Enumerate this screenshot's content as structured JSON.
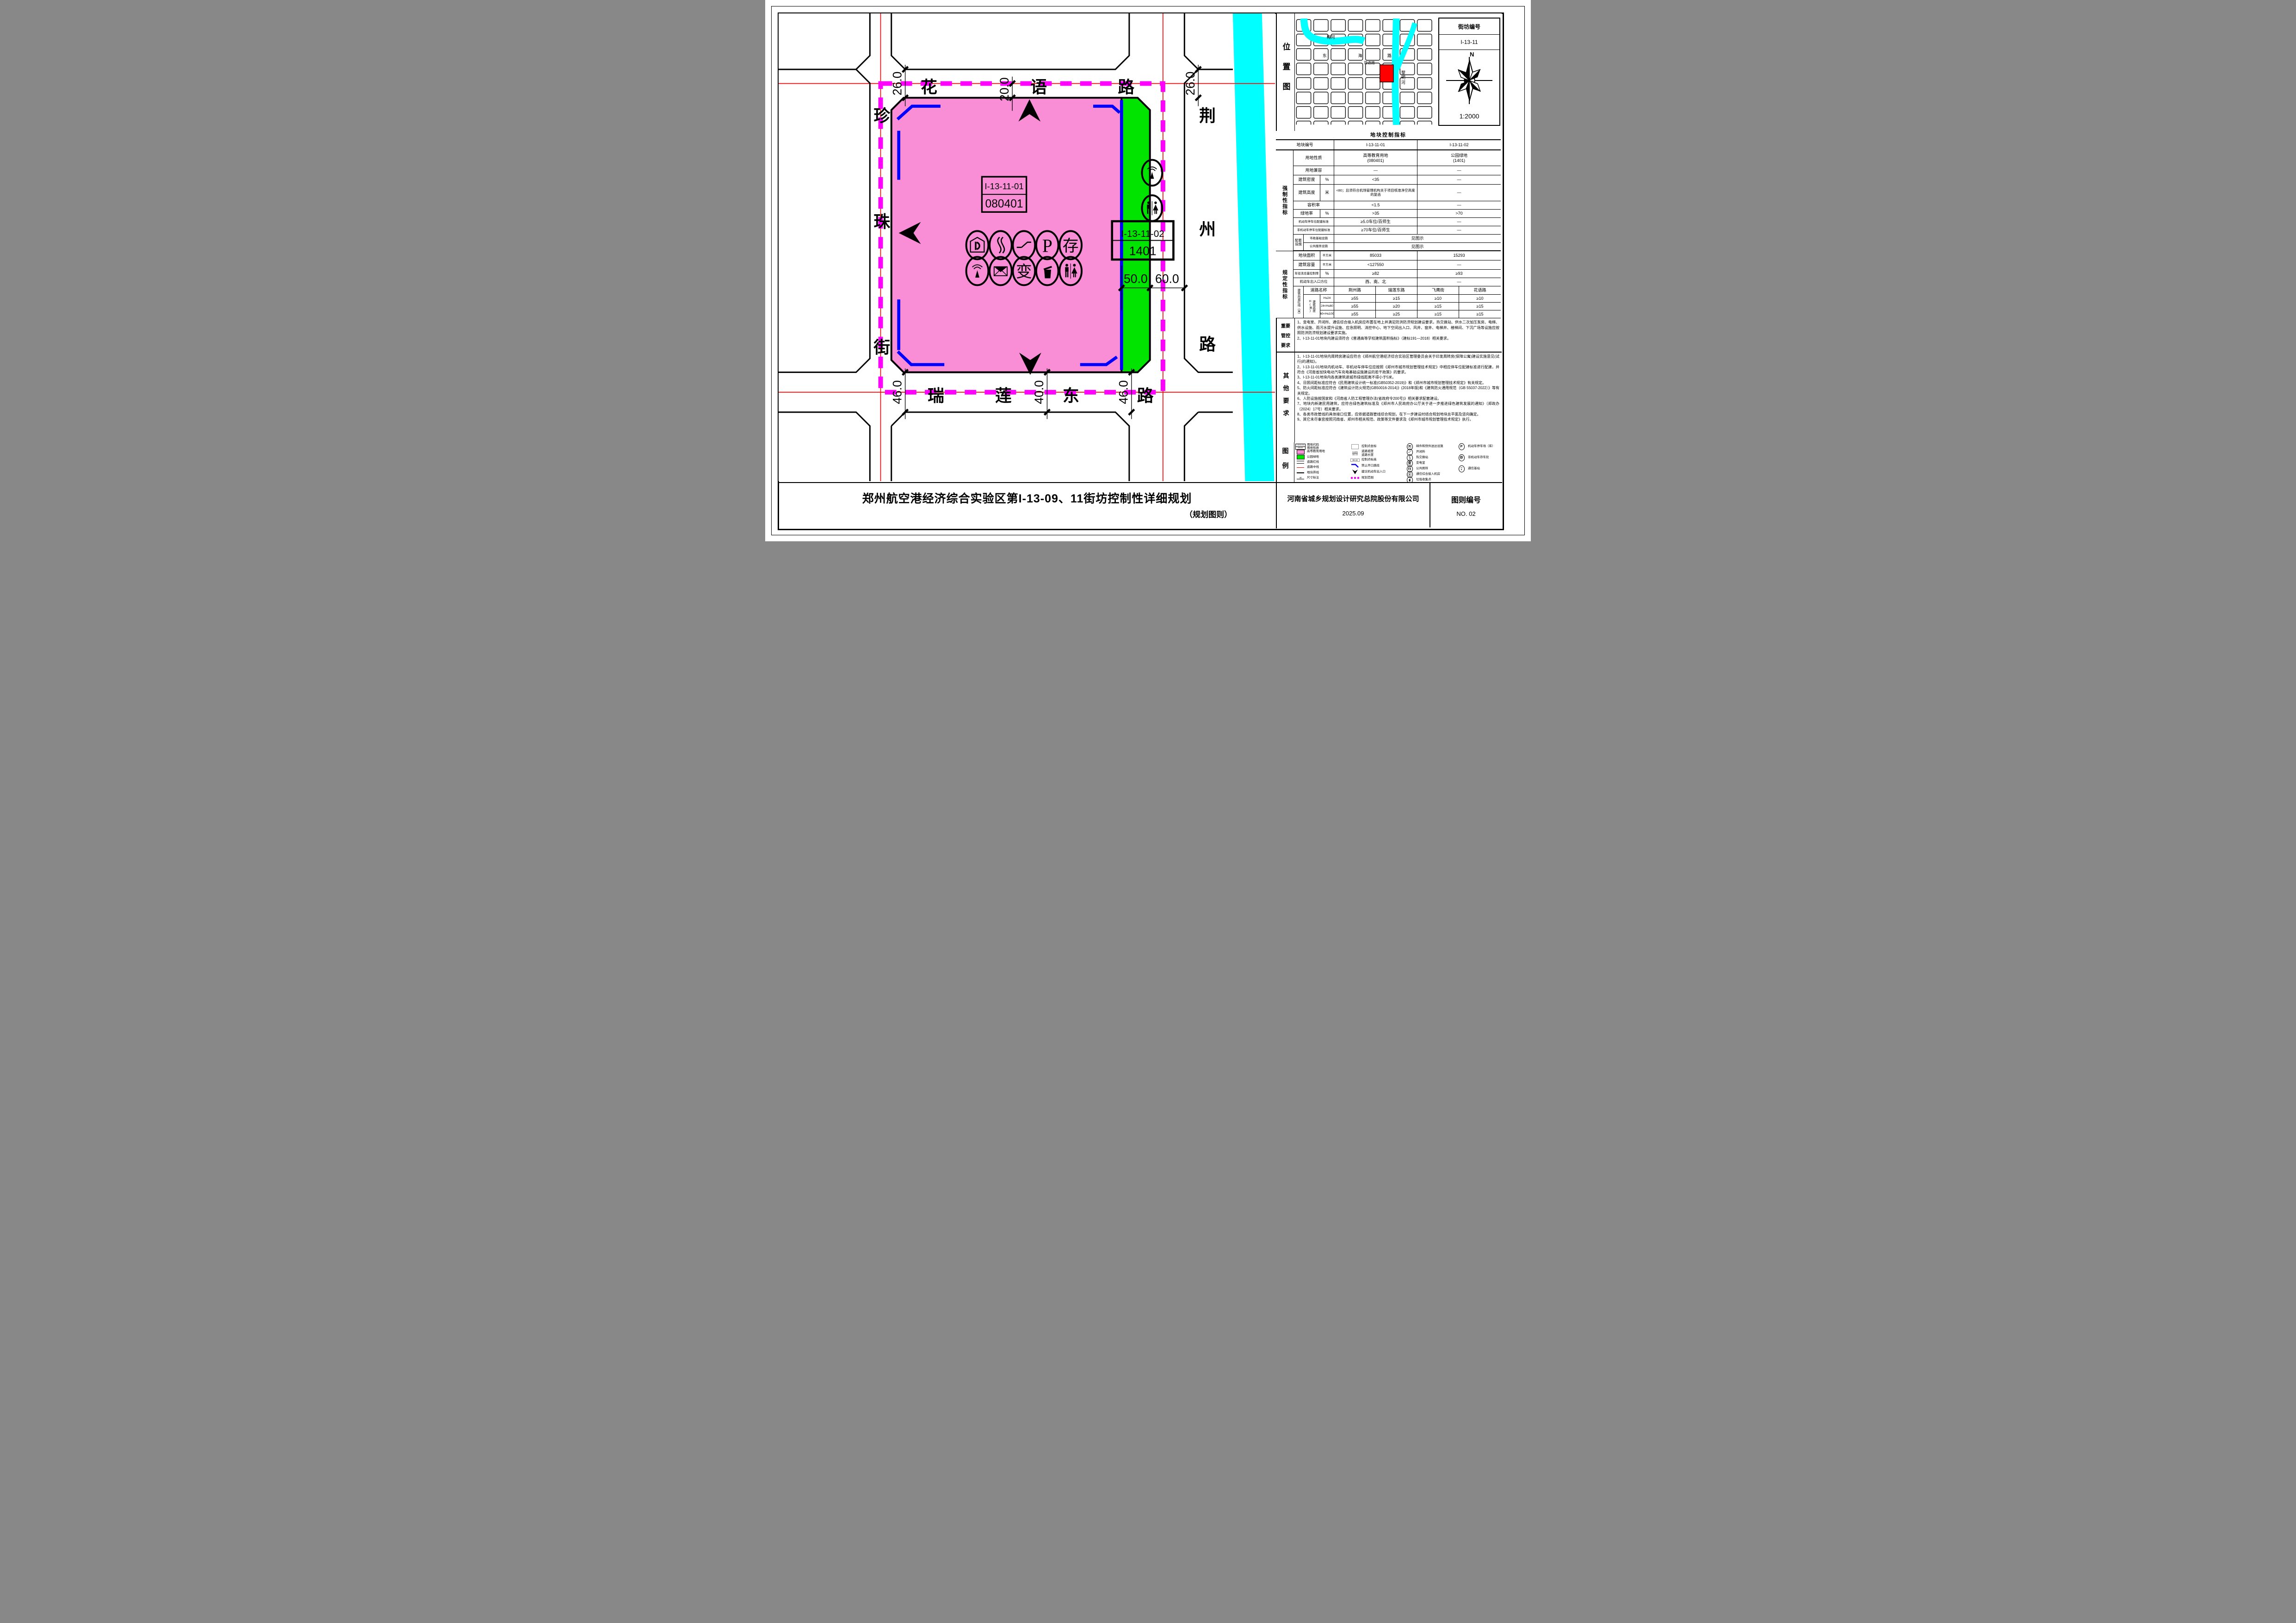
{
  "map": {
    "top_road": [
      "花",
      "语",
      "路"
    ],
    "right_road": [
      "荆",
      "州",
      "路"
    ],
    "left_road": [
      "珍",
      "珠",
      "街"
    ],
    "bottom_road": [
      "瑞",
      "莲",
      "东",
      "路"
    ],
    "dim_top": [
      "26.0",
      "20.0",
      "26.0"
    ],
    "dim_bottom": [
      "46.0",
      "40.0",
      "46.0"
    ],
    "dim_right": [
      "50.0",
      "60.0"
    ],
    "parcel_main": {
      "code": "I-13-11-01",
      "use_code": "080401"
    },
    "parcel_green": {
      "code": "I-13-11-02",
      "use_code": "1401"
    }
  },
  "location_map": {
    "label": "位置图",
    "street_top": [
      "东",
      "海",
      "路"
    ],
    "river1": "梅河",
    "river2": [
      "黎",
      "明",
      "河"
    ],
    "street_near": "花语路"
  },
  "block_header": {
    "title": "街坊编号",
    "value": "I-13-11",
    "north_label": "N",
    "scale": "1:2000"
  },
  "control_table": {
    "title": "地块控制指标",
    "group_mandatory": "强制性指标",
    "group_regulatory": "规定性指标",
    "row_plot_no": {
      "label": "地块编号",
      "v1": "I-13-11-01",
      "v2": "I-13-11-02"
    },
    "row_use": {
      "label": "用地性质",
      "v1_line1": "高等教育用地",
      "v1_line2": "(080401)",
      "v2_line1": "公园绿地",
      "v2_line2": "(1401)"
    },
    "row_compat": {
      "label": "用地兼容",
      "v1": "—",
      "v2": "—"
    },
    "row_density": {
      "label": "建筑密度",
      "unit": "%",
      "v1": "<35",
      "v2": "—"
    },
    "row_height": {
      "label": "建筑高度",
      "unit": "米",
      "v1": "<80；且须符合机场管理机构关于项目核准净空高度的复函",
      "v2": "—"
    },
    "row_far": {
      "label": "容积率",
      "v1": "<1.5",
      "v2": "—"
    },
    "row_green": {
      "label": "绿地率",
      "unit": "%",
      "v1": ">35",
      "v2": ">70"
    },
    "row_parking": {
      "label": "机动车停车位配建标准",
      "v1": "≥5.0车位/百师生",
      "v2": "—"
    },
    "row_bike": {
      "label": "非机动车停车位配建标准",
      "v1": "≥70车位/百师生",
      "v2": "—"
    },
    "row_support": {
      "label": "配套设施",
      "sub1": "市政基础设施",
      "sub2": "公共服务设施",
      "v1": "见图示",
      "v2": "见图示"
    },
    "row_area": {
      "label": "地块面积",
      "unit": "平方米",
      "v1": "85033",
      "v2": "15293"
    },
    "row_capacity": {
      "label": "建筑容量",
      "unit": "平方米",
      "v1": "<127550",
      "v2": "—"
    },
    "row_runoff": {
      "label": "年径流总量控制率",
      "unit": "%",
      "v1": "≥82",
      "v2": "≥93"
    },
    "row_access": {
      "label": "机动车出入口方位",
      "v1": "西、南、北",
      "v2": "—"
    },
    "setback": {
      "label": "建筑后退红线（米）",
      "road_header": "道路名称",
      "height_header": "建筑高度H(米)",
      "roads": [
        "荆州路",
        "瑞莲东路",
        "飞鹰街",
        "花语路"
      ],
      "bands": [
        {
          "range": "H≤24",
          "v": [
            "≥55",
            "≥15",
            "≥10",
            "≥10"
          ]
        },
        {
          "range": "24<H≤60",
          "v": [
            "≥55",
            "≥20",
            "≥15",
            "≥15"
          ]
        },
        {
          "range": "60<H≤100",
          "v": [
            "≥55",
            "≥25",
            "≥15",
            "≥15"
          ]
        }
      ]
    }
  },
  "key_control": {
    "label_lines": [
      "重要",
      "管控",
      "要求"
    ],
    "items": [
      "1、变电室、开闭所、通信综合接入机房应布置在地上并满足防洪防涝规划建设要求。热交换站、供水二次加压泵房、电梯、供水设施、雨污水提升设施、应急照明、消控中心、地下空间出入口、风井、窗井、电梯井、楼梯间、下沉广场等设施应按照防洪防涝规划建设要求实施。",
      "2、I-13-11-01地块内建设须符合《普通高等学校建筑面积指标》（建标191—2018）相关要求。"
    ]
  },
  "other_req": {
    "label": "其他要求",
    "items": [
      "1、I-13-11-01地块内周转房建设应符合《郑州航空港经济综合实验区管理委员会关于印发周转房(保障公寓)建设实施意见(试行)的通知》。",
      "2、I-13-11-01地块内机动车、非机动车停车位应按照《郑州市城市规划管理技术规定》中相应停车位配建标准进行配建，并符合《河南省加快电动汽车充电基础设施建设的若干政策》的要求。",
      "3、I-13-11-01地块内各类建筑退城市绿线距离不得小于5米。",
      "4、日照间距标准应符合《民用建筑设计统一标准(GB50352-2019)》和《郑州市城市规划管理技术规定》有关规定。",
      "5、防火间距标准应符合《建筑设计防火规范(GB50016-2014)》(2018年版)和《建筑防火通用规范（GB 55037-2022）》等有关规定。",
      "6、人防设施按国家和《河南省人防工程管理办法(省政府令200号)》相关要求配套建设。",
      "7、地块内新建民用建筑，应符合绿色建筑标准及《郑州市人民政府办公厅关于进一步推进绿色建筑发展的通知》（郑政办〔2024〕17号）相关要求。",
      "8、各类市政管线的具体接口位置，应依据道路管线综合规划，在下一步建设时结合规划地块总平面及竖向确定。",
      "9、其它未尽事宜按照河南省、郑州市相关规范、政策等文件要求及《郑州市城市规划管理技术规定》执行。"
    ]
  },
  "legend": {
    "label": "图例",
    "col1": [
      {
        "label": "用地代码",
        "label2": "用地性质",
        "box_line1": "I-13-11-01",
        "box_line2": "080401"
      },
      {
        "label": "高等教育用地"
      },
      {
        "label": "公园绿地"
      },
      {
        "label": "道路红线"
      },
      {
        "label": "道路中线"
      },
      {
        "label": "地块界线"
      },
      {
        "label": "尺寸标注",
        "value": "40"
      }
    ],
    "col2": [
      {
        "label": "控制点坐标"
      },
      {
        "label": "道路坡度",
        "label2": "道路长度",
        "top": "0.10%",
        "bottom": "360.00"
      },
      {
        "label": "控制点标高",
        "value": "99.18"
      },
      {
        "label": "禁止开口路段"
      },
      {
        "label": "建议机动车出入口"
      },
      {
        "label": "规划范围"
      }
    ],
    "col3": [
      {
        "label": "邮件和快件送达设施"
      },
      {
        "label": "开闭所"
      },
      {
        "label": "热交换站"
      },
      {
        "label": "变电室",
        "char": "变"
      },
      {
        "label": "公共厕所"
      },
      {
        "label": "通信综合接入机房"
      },
      {
        "label": "垃圾收集点"
      }
    ],
    "col4": [
      {
        "label": "机动车停车场（库）",
        "char": "P"
      },
      {
        "label": "非机动车存车处",
        "char": "存"
      },
      {
        "label": "通信基站"
      }
    ]
  },
  "footer": {
    "title": "郑州航空港经济综合实验区第I-13-09、11街坊控制性详细规划",
    "subtitle": "（规划图则）",
    "company": "河南省城乡规划设计研究总院股份有限公司",
    "date": "2025.09",
    "sheet_label": "图则编号",
    "sheet_no": "NO. 02"
  },
  "colors": {
    "edu_pink": "#F98DD6",
    "park_green": "#00E400",
    "range_magenta": "#FF00FF",
    "centerline_red": "#FF0000",
    "no_open_blue": "#0000FF",
    "river_cyan": "#00FFFF",
    "site_red": "#FF0000"
  }
}
